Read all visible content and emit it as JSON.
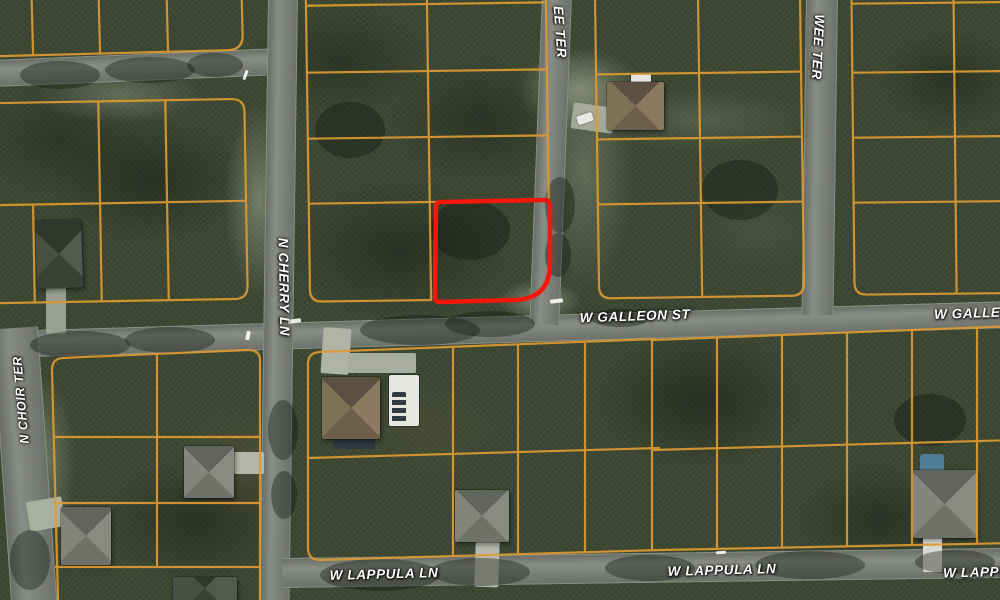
{
  "view": {
    "type": "satellite-parcel-map",
    "width": 1000,
    "height": 600
  },
  "streets": {
    "cherry": {
      "label": "N CHERRY LN"
    },
    "choir": {
      "label": "N CHOIR TER"
    },
    "ee_ter": {
      "label": "EE TER"
    },
    "wee_ter": {
      "label": "WEE TER"
    },
    "galleon": {
      "label": "W GALLEON ST"
    },
    "galleon_partial": {
      "label": "W GALLEON"
    },
    "lappula_west": {
      "label": "W LAPPULA LN"
    },
    "lappula_east": {
      "label": "W LAPPULA LN"
    },
    "lappula_partial": {
      "label": "W LAPPULA"
    }
  },
  "highlight": {
    "name": "highlighted-parcel",
    "color": "#f5170c"
  },
  "colors": {
    "parcel_line": "#dd9a33",
    "road": "#7d8279",
    "vegetation": "#3d4833",
    "label_text": "#ffffff"
  }
}
